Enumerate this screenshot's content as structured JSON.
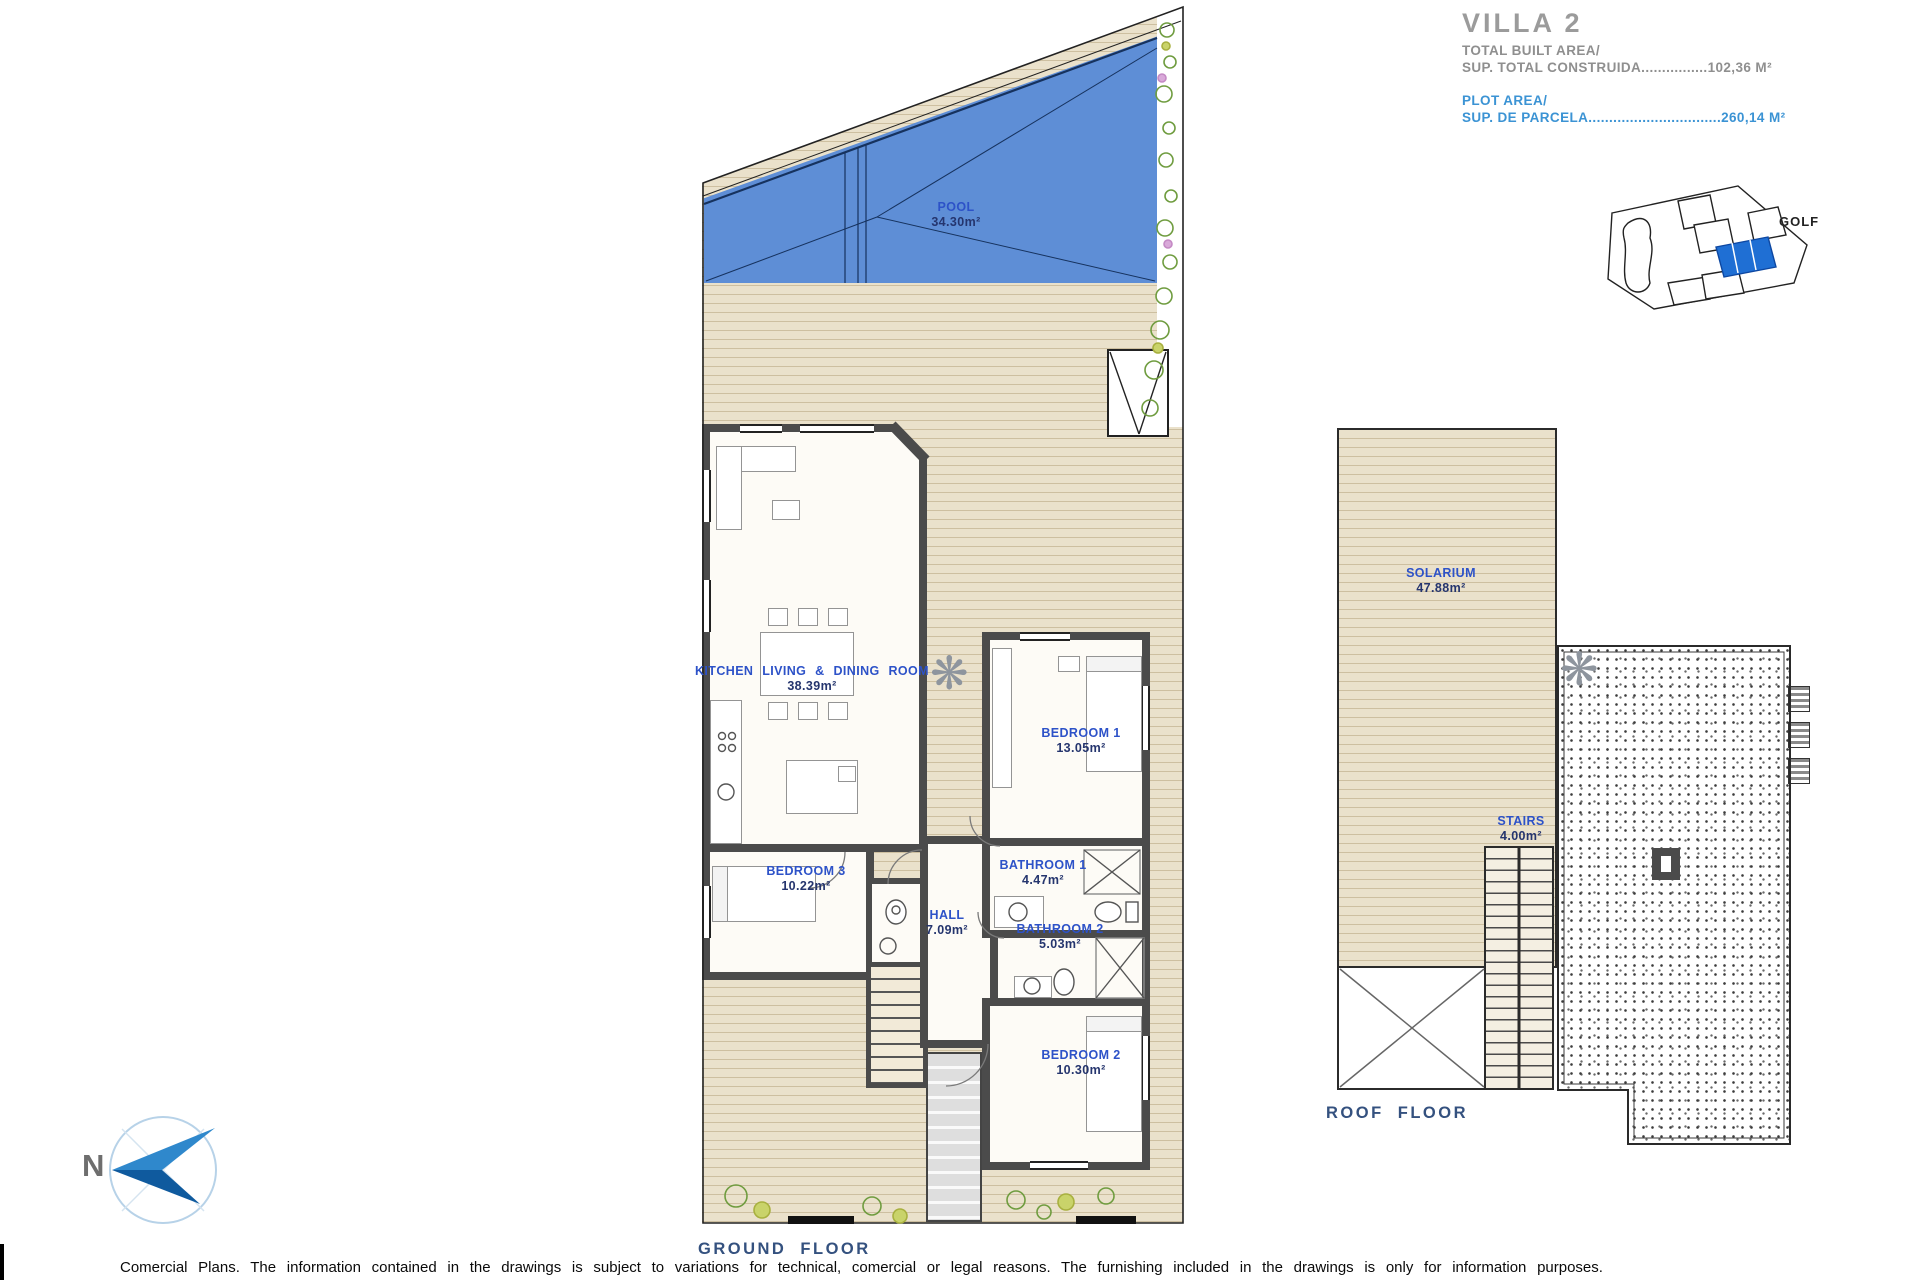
{
  "title_block": {
    "villa": "VILLA 2",
    "built_area_en": "TOTAL BUILT AREA/",
    "built_area_line": "SUP. TOTAL CONSTRUIDA................102,36 M²",
    "plot_area_en": "PLOT AREA/",
    "plot_area_line": "SUP. DE PARCELA................................260,14 M²"
  },
  "inset": {
    "golf_label": "GOLF"
  },
  "north": {
    "letter": "N"
  },
  "icons": {
    "deck_ornament": "❋"
  },
  "ground": {
    "floor_label": "GROUND FLOOR",
    "rooms": {
      "pool": {
        "name": "POOL",
        "area": "34.30m²"
      },
      "kitchen": {
        "name": "KITCHEN LIVING & DINING ROOM",
        "area": "38.39m²"
      },
      "bedroom1": {
        "name": "BEDROOM 1",
        "area": "13.05m²"
      },
      "bathroom1": {
        "name": "BATHROOM 1",
        "area": "4.47m²"
      },
      "bathroom2": {
        "name": "BATHROOM 2",
        "area": "5.03m²"
      },
      "hall": {
        "name": "HALL",
        "area": "7.09m²"
      },
      "bedroom3": {
        "name": "BEDROOM 3",
        "area": "10.22m²"
      },
      "bedroom2": {
        "name": "BEDROOM 2",
        "area": "10.30m²"
      }
    }
  },
  "roof": {
    "floor_label": "ROOF FLOOR",
    "rooms": {
      "solarium": {
        "name": "SOLARIUM",
        "area": "47.88m²"
      },
      "stairs": {
        "name": "STAIRS",
        "area": "4.00m²"
      }
    }
  },
  "footer": {
    "disclaimer": "Comercial Plans. The information contained in the drawings is subject to variations for technical, comercial or legal reasons. The furnishing included in the drawings is only for information purposes."
  },
  "colors": {
    "pool": "#5e8ed6",
    "deck": "#eae1cb",
    "wall": "#4b4b4b",
    "room_label": "#2d52c8",
    "area_label": "#25356e",
    "title_gray": "#9b9b9b",
    "title_blue": "#3b93d4",
    "floor_label": "#34517f",
    "plot_highlight": "#1f6fd4"
  }
}
